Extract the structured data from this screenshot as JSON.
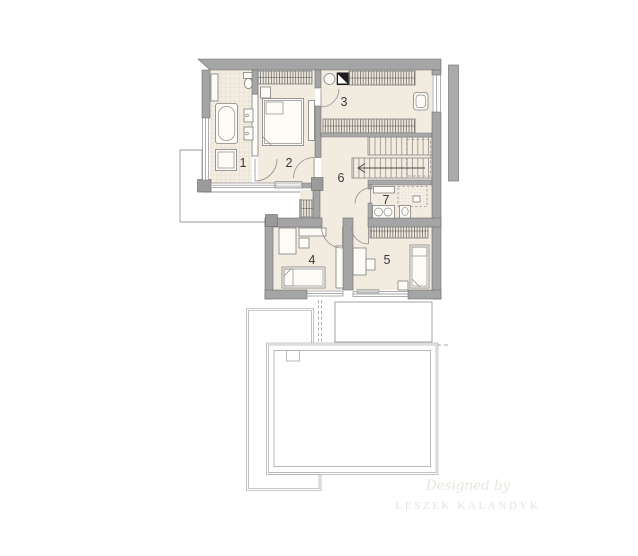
{
  "title": "First floor plan",
  "rooms": [
    {
      "label": "1"
    },
    {
      "label": "2"
    },
    {
      "label": "3"
    },
    {
      "label": "4"
    },
    {
      "label": "5"
    },
    {
      "label": "6"
    },
    {
      "label": "7"
    }
  ],
  "watermark": {
    "line1": "Designed by",
    "line2": "LESZEK KALANDYK"
  },
  "colors": {
    "wall": "#a5a5a5",
    "wall_edge": "#6f6f6f",
    "floor": "#f2ebe0",
    "outline": "#a8a8a8",
    "watermark": "#e9e5df",
    "watermark2": "#e7e3dc"
  }
}
